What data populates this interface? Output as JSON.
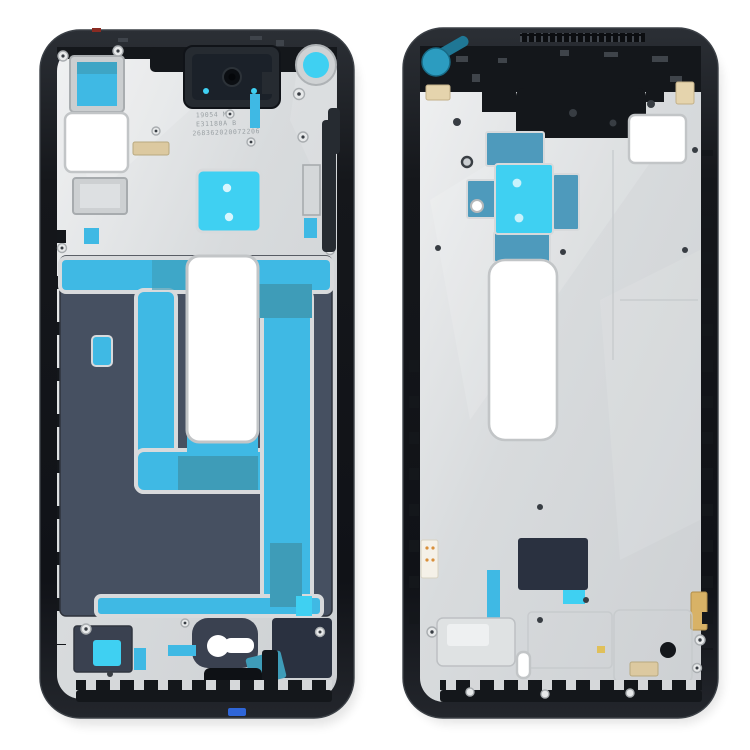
{
  "background": "#ffffff",
  "colors": {
    "background": "#ffffff",
    "frame_black": "#14171b",
    "frame_inner": "#262b31",
    "frame_edge": "#3c4147",
    "plate_silver": "#d7dadb",
    "plate_light": "#eff0f1",
    "plate_dark": "#c3c6c9",
    "graphite": "#465061",
    "graphite_dark": "#3a4150",
    "cyan": "#3fb9e4",
    "cyan_bright": "#3fd0f2",
    "teal": "#3e9cb8",
    "steel_blue": "#4e9abc",
    "teal_circle": "#2c9cc0",
    "teal_tab": "#1f7795",
    "navy": "#2a3140",
    "tan": "#dcc9a0",
    "beige": "#e5d4ad",
    "gold": "#d8b266",
    "blue_tab": "#2f66d8",
    "red_mark": "#8a2b22",
    "channel": "#d8dadc",
    "rim": "#c2c5c7",
    "emboss": "#c6c9cb",
    "boss": "#e7e9ea",
    "boss_rim": "#a9adb0",
    "screw": "#383d43",
    "etch_text": "#8f969a"
  },
  "left_frame": {
    "view": "front housing LCD frame bezel - front view",
    "etched_lines": [
      "19054 M",
      "E31180A B",
      "268362020072206"
    ]
  },
  "right_frame": {
    "view": "front housing LCD frame bezel - inner view"
  }
}
